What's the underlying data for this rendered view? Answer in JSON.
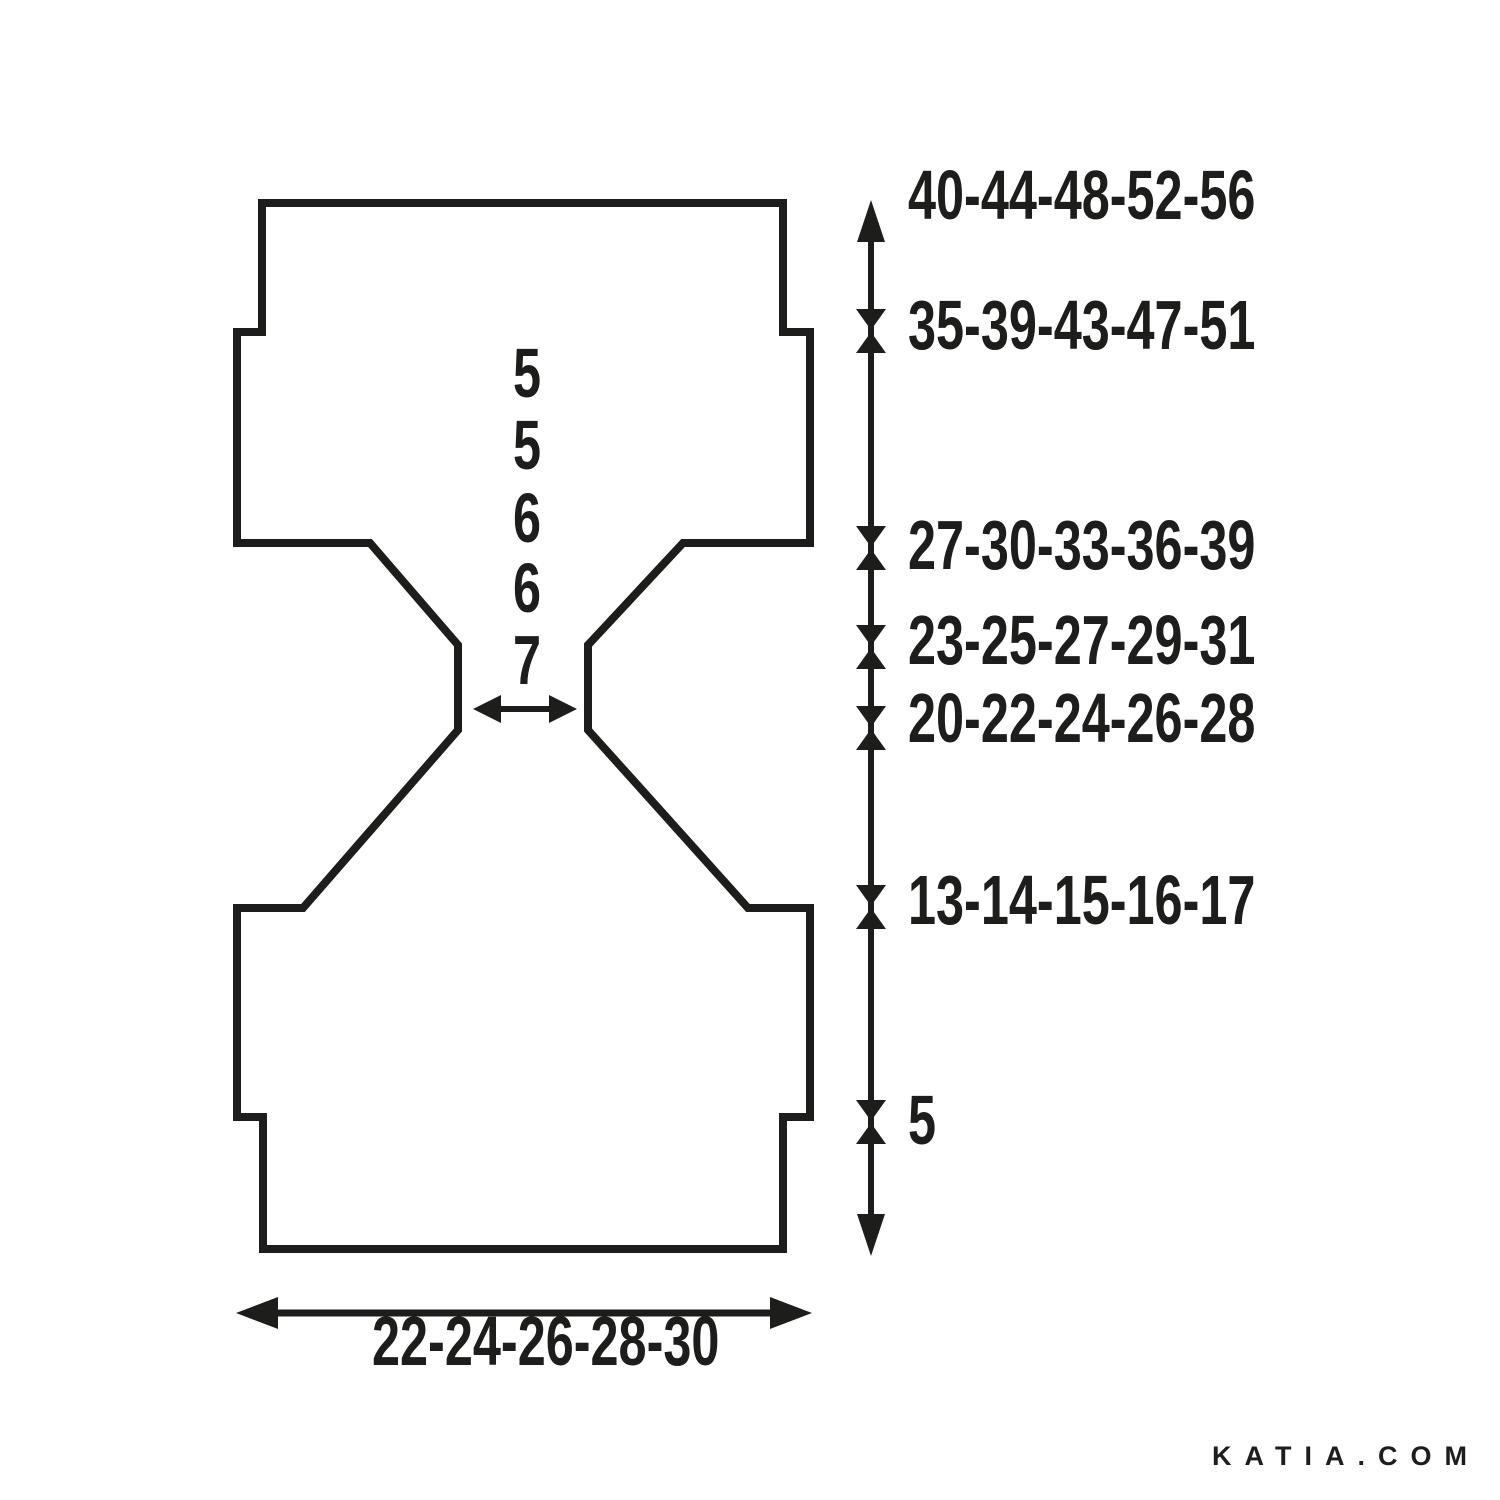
{
  "colors": {
    "ink": "#1d1d1b",
    "background": "#ffffff"
  },
  "schematic": {
    "right_measurements": [
      "40-44-48-52-56",
      "35-39-43-47-51",
      "27-30-33-36-39",
      "23-25-27-29-31",
      "20-22-24-26-28",
      "13-14-15-16-17",
      "5"
    ],
    "center_measurements": [
      "5",
      "5",
      "6",
      "6",
      "7"
    ],
    "bottom_measurement": "22-24-26-28-30"
  },
  "footer": {
    "brand": "KATIA.COM"
  }
}
